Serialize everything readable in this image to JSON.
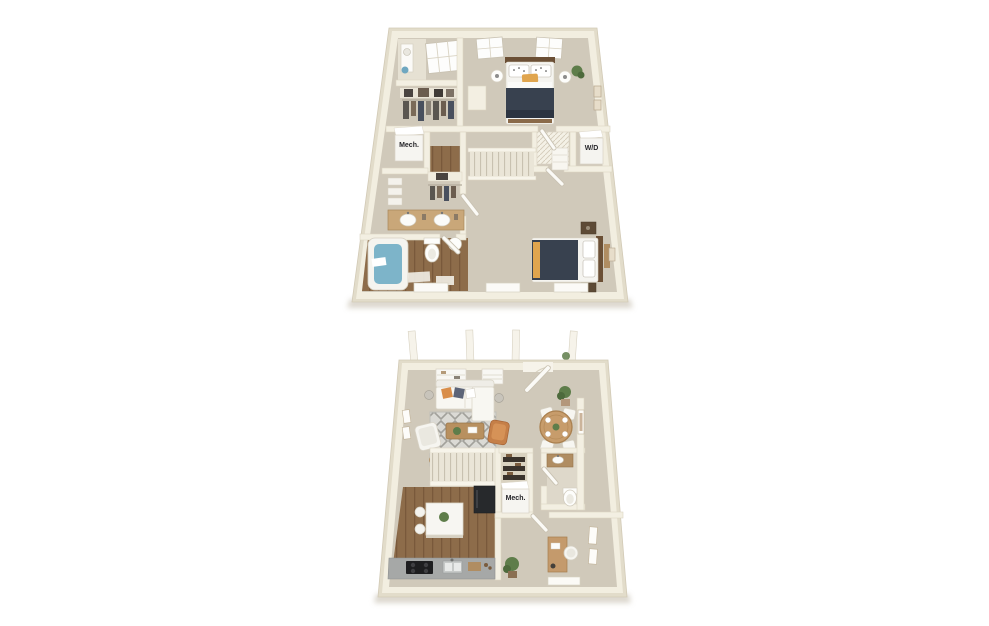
{
  "scene": {
    "type": "3d-floor-plan-rendering",
    "background": "#ffffff",
    "floors": [
      {
        "id": "upper",
        "position": "top",
        "labels": {
          "mech": "Mech.",
          "washer_dryer": "W/D"
        },
        "rooms": [
          "bedroom-1",
          "bedroom-2",
          "bathroom-1",
          "bathroom-2",
          "walk-in-closet",
          "closet",
          "mechanical-closet",
          "laundry-closet",
          "stairs",
          "hallway"
        ]
      },
      {
        "id": "lower",
        "position": "bottom",
        "labels": {
          "mech": "Mech."
        },
        "rooms": [
          "living-room",
          "dining-area",
          "kitchen",
          "half-bathroom",
          "pantry",
          "mechanical-closet",
          "den-office",
          "stairs",
          "entry",
          "front-porch"
        ]
      }
    ]
  },
  "palette": {
    "wall_top": "#f2eee0",
    "wall_side": "#e2dcca",
    "carpet": "#d0c9ba",
    "wood_floor": "#8d6c4a",
    "bed_navy": "#38414f",
    "tub_blue": "#7db4c9",
    "counter_gray": "#a6a8a7",
    "sofa_white": "#f8f7f2",
    "chair_tan": "#c57f48",
    "accent_mustard": "#e0a54e",
    "plant_green": "#5e7d4a",
    "appliance_black": "#27292c"
  }
}
